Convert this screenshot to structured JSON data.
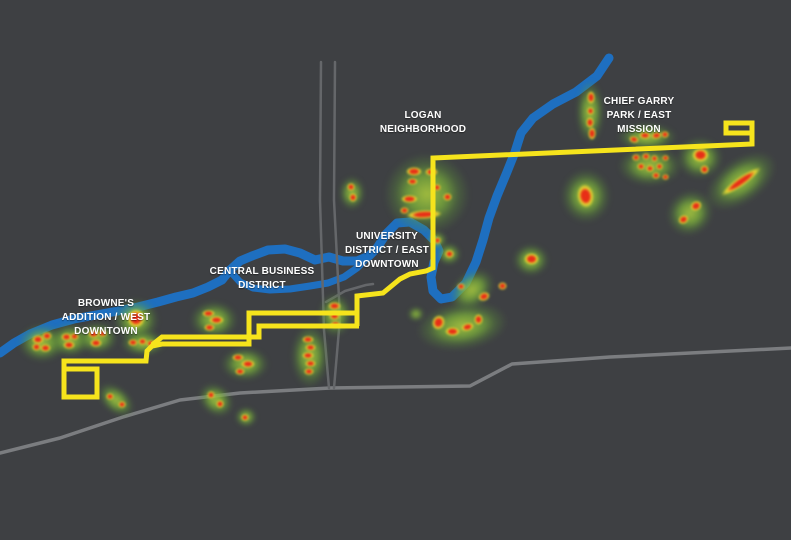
{
  "map": {
    "background_color": "#3e4043",
    "river_color": "#1e6fc0",
    "river_channel_color": "#1e6fc0",
    "route_color": "#f6e41c",
    "road_color": "#7b7d80",
    "minor_road_color": "#65676a",
    "heat_core_color": "#e62c16",
    "heat_glow_color": "#7db53a",
    "labels": [
      {
        "id": "brownes",
        "lines": [
          "BROWNE'S",
          "ADDITION / WEST",
          "DOWNTOWN"
        ],
        "x": 106,
        "y": 297
      },
      {
        "id": "cbd",
        "lines": [
          "CENTRAL BUSINESS",
          "DISTRICT"
        ],
        "x": 262,
        "y": 265
      },
      {
        "id": "university",
        "lines": [
          "UNIVERSITY",
          "DISTRICT / EAST",
          "DOWNTOWN"
        ],
        "x": 387,
        "y": 230
      },
      {
        "id": "logan",
        "lines": [
          "LOGAN",
          "NEIGHBORHOOD"
        ],
        "x": 423,
        "y": 109
      },
      {
        "id": "chief-garry",
        "lines": [
          "CHIEF GARRY",
          "PARK / EAST",
          "MISSION"
        ],
        "x": 639,
        "y": 95
      }
    ],
    "rivers": [
      {
        "name": "spokane-river-main",
        "width": 9,
        "points": [
          [
            609,
            58
          ],
          [
            597,
            76
          ],
          [
            576,
            92
          ],
          [
            553,
            104
          ],
          [
            533,
            118
          ],
          [
            521,
            133
          ],
          [
            515,
            152
          ],
          [
            507,
            172
          ],
          [
            497,
            196
          ],
          [
            489,
            218
          ],
          [
            483,
            240
          ],
          [
            476,
            262
          ],
          [
            466,
            283
          ],
          [
            452,
            297
          ],
          [
            441,
            299
          ],
          [
            433,
            291
          ],
          [
            431,
            277
          ],
          [
            434,
            262
          ],
          [
            439,
            251
          ],
          [
            434,
            240
          ],
          [
            424,
            230
          ],
          [
            410,
            222
          ],
          [
            397,
            223
          ],
          [
            386,
            234
          ],
          [
            377,
            248
          ],
          [
            369,
            256
          ],
          [
            357,
            261
          ],
          [
            343,
            261
          ],
          [
            329,
            257
          ],
          [
            315,
            260
          ],
          [
            300,
            253
          ],
          [
            285,
            249
          ],
          [
            268,
            250
          ],
          [
            252,
            256
          ],
          [
            240,
            261
          ],
          [
            230,
            270
          ],
          [
            222,
            280
          ],
          [
            208,
            287
          ],
          [
            193,
            293
          ],
          [
            176,
            297
          ],
          [
            158,
            302
          ],
          [
            138,
            307
          ],
          [
            118,
            311
          ],
          [
            96,
            315
          ],
          [
            74,
            319
          ],
          [
            52,
            325
          ],
          [
            30,
            334
          ],
          [
            14,
            343
          ],
          [
            0,
            353
          ]
        ]
      },
      {
        "name": "spokane-river-south-channel",
        "width": 7,
        "points": [
          [
            370,
            255
          ],
          [
            357,
            268
          ],
          [
            344,
            277
          ],
          [
            328,
            283
          ],
          [
            310,
            286
          ],
          [
            290,
            289
          ],
          [
            270,
            290
          ],
          [
            253,
            288
          ],
          [
            240,
            282
          ],
          [
            230,
            271
          ]
        ]
      }
    ],
    "roads": [
      {
        "name": "road-southwest-arterial",
        "width": 3.5,
        "minor": false,
        "points": [
          [
            0,
            453
          ],
          [
            60,
            438
          ],
          [
            123,
            417
          ],
          [
            180,
            400
          ],
          [
            240,
            393
          ],
          [
            330,
            388
          ],
          [
            470,
            386
          ],
          [
            512,
            364
          ],
          [
            610,
            357
          ],
          [
            791,
            348
          ]
        ]
      },
      {
        "name": "road-north-south-1",
        "width": 2.5,
        "minor": true,
        "points": [
          [
            321,
            62
          ],
          [
            320,
            200
          ],
          [
            324,
            330
          ],
          [
            329,
            388
          ]
        ]
      },
      {
        "name": "road-north-south-2",
        "width": 2.5,
        "minor": true,
        "points": [
          [
            335,
            62
          ],
          [
            334,
            200
          ],
          [
            340,
            318
          ],
          [
            334,
            388
          ]
        ]
      },
      {
        "name": "road-spur-ne",
        "width": 2.5,
        "minor": true,
        "points": [
          [
            326,
            302
          ],
          [
            345,
            291
          ],
          [
            366,
            285
          ],
          [
            373,
            284
          ]
        ]
      }
    ],
    "route_segments": [
      {
        "name": "route-main",
        "points": [
          [
            750,
            133
          ],
          [
            726,
            133
          ],
          [
            726,
            123
          ],
          [
            752,
            123
          ],
          [
            752,
            144
          ],
          [
            433,
            158
          ],
          [
            433,
            268
          ],
          [
            426,
            271
          ],
          [
            410,
            274
          ],
          [
            400,
            279
          ],
          [
            383,
            293
          ],
          [
            357,
            296
          ],
          [
            357,
            326
          ]
        ]
      },
      {
        "name": "route-westbound-couplet",
        "points": [
          [
            357,
            313
          ],
          [
            249,
            313
          ],
          [
            249,
            344
          ],
          [
            162,
            344
          ],
          [
            152,
            346
          ],
          [
            147,
            351
          ],
          [
            146,
            361
          ],
          [
            64,
            361
          ],
          [
            64,
            397
          ],
          [
            97,
            397
          ],
          [
            97,
            369
          ],
          [
            63,
            369
          ]
        ]
      },
      {
        "name": "route-eastbound-couplet",
        "points": [
          [
            152,
            345
          ],
          [
            162,
            337
          ],
          [
            259,
            337
          ],
          [
            259,
            326
          ],
          [
            359,
            326
          ]
        ]
      }
    ],
    "heat_glows": [
      [
        42,
        343,
        48,
        38,
        0
      ],
      [
        70,
        340,
        42,
        34,
        0
      ],
      [
        97,
        338,
        42,
        32,
        0
      ],
      [
        136,
        320,
        46,
        44,
        0
      ],
      [
        143,
        343,
        46,
        26,
        0
      ],
      [
        116,
        400,
        42,
        26,
        40
      ],
      [
        216,
        400,
        38,
        30,
        40
      ],
      [
        246,
        417,
        22,
        20,
        0
      ],
      [
        214,
        320,
        48,
        38,
        0
      ],
      [
        245,
        364,
        48,
        34,
        0
      ],
      [
        310,
        356,
        38,
        64,
        0
      ],
      [
        335,
        315,
        34,
        44,
        0
      ],
      [
        352,
        193,
        26,
        34,
        0
      ],
      [
        427,
        194,
        86,
        82,
        0
      ],
      [
        437,
        240,
        20,
        18,
        0
      ],
      [
        449,
        254,
        24,
        22,
        0
      ],
      [
        472,
        290,
        50,
        36,
        -40
      ],
      [
        531,
        260,
        36,
        32,
        0
      ],
      [
        462,
        326,
        92,
        48,
        -8
      ],
      [
        416,
        314,
        16,
        14,
        0
      ],
      [
        590,
        112,
        28,
        64,
        0
      ],
      [
        647,
        137,
        60,
        28,
        0
      ],
      [
        650,
        166,
        64,
        40,
        0
      ],
      [
        700,
        158,
        46,
        42,
        0
      ],
      [
        741,
        181,
        80,
        44,
        -35
      ],
      [
        586,
        196,
        50,
        54,
        0
      ],
      [
        690,
        213,
        48,
        44,
        -40
      ]
    ],
    "heat_cores": [
      [
        38,
        339,
        12,
        9,
        0
      ],
      [
        47,
        336,
        10,
        8,
        0
      ],
      [
        36,
        347,
        9,
        8,
        0
      ],
      [
        45,
        348,
        11,
        8,
        0
      ],
      [
        66,
        337,
        11,
        8,
        0
      ],
      [
        74,
        336,
        9,
        7,
        0
      ],
      [
        69,
        345,
        12,
        8,
        0
      ],
      [
        93,
        334,
        11,
        8,
        0
      ],
      [
        102,
        333,
        9,
        7,
        0
      ],
      [
        96,
        343,
        12,
        8,
        0
      ],
      [
        136,
        318,
        18,
        19,
        0
      ],
      [
        133,
        342,
        10,
        7,
        0
      ],
      [
        142,
        341,
        9,
        7,
        0
      ],
      [
        151,
        343,
        10,
        7,
        0
      ],
      [
        110,
        396,
        8,
        7,
        0
      ],
      [
        122,
        404,
        8,
        7,
        0
      ],
      [
        211,
        395,
        8,
        8,
        0
      ],
      [
        220,
        404,
        8,
        8,
        0
      ],
      [
        245,
        417,
        8,
        7,
        0
      ],
      [
        208,
        313,
        13,
        7,
        0
      ],
      [
        216,
        320,
        15,
        8,
        0
      ],
      [
        209,
        327,
        11,
        7,
        0
      ],
      [
        238,
        357,
        12,
        7,
        0
      ],
      [
        248,
        364,
        14,
        8,
        0
      ],
      [
        240,
        371,
        10,
        7,
        0
      ],
      [
        308,
        339,
        12,
        7,
        0
      ],
      [
        310,
        347,
        11,
        7,
        0
      ],
      [
        308,
        355,
        12,
        7,
        0
      ],
      [
        310,
        363,
        11,
        7,
        0
      ],
      [
        309,
        371,
        10,
        7,
        0
      ],
      [
        334,
        306,
        13,
        8,
        0
      ],
      [
        334,
        316,
        11,
        8,
        0
      ],
      [
        335,
        324,
        11,
        7,
        0
      ],
      [
        351,
        187,
        8,
        8,
        0
      ],
      [
        353,
        197,
        8,
        9,
        0
      ],
      [
        414,
        171,
        16,
        9,
        0
      ],
      [
        431,
        172,
        13,
        8,
        0
      ],
      [
        412,
        181,
        11,
        7,
        0
      ],
      [
        437,
        187,
        8,
        7,
        0
      ],
      [
        409,
        199,
        17,
        8,
        0
      ],
      [
        424,
        214,
        36,
        9,
        -3
      ],
      [
        447,
        197,
        9,
        8,
        0
      ],
      [
        404,
        210,
        9,
        7,
        0
      ],
      [
        437,
        240,
        7,
        7,
        0
      ],
      [
        449,
        254,
        9,
        8,
        0
      ],
      [
        461,
        286,
        8,
        7,
        0
      ],
      [
        484,
        296,
        12,
        9,
        -20
      ],
      [
        502,
        286,
        9,
        8,
        0
      ],
      [
        531,
        259,
        15,
        12,
        0
      ],
      [
        438,
        322,
        13,
        15,
        20
      ],
      [
        452,
        331,
        15,
        9,
        0
      ],
      [
        467,
        327,
        13,
        8,
        -15
      ],
      [
        478,
        319,
        9,
        11,
        0
      ],
      [
        591,
        97,
        8,
        13,
        0
      ],
      [
        590,
        111,
        7,
        8,
        0
      ],
      [
        590,
        122,
        8,
        11,
        0
      ],
      [
        592,
        133,
        8,
        13,
        0
      ],
      [
        634,
        139,
        10,
        7,
        15
      ],
      [
        645,
        135,
        12,
        7,
        0
      ],
      [
        656,
        135,
        11,
        7,
        -10
      ],
      [
        665,
        134,
        8,
        7,
        0
      ],
      [
        636,
        157,
        8,
        7,
        0
      ],
      [
        646,
        156,
        8,
        7,
        0
      ],
      [
        654,
        158,
        7,
        7,
        0
      ],
      [
        641,
        166,
        8,
        7,
        0
      ],
      [
        650,
        168,
        8,
        7,
        0
      ],
      [
        659,
        166,
        7,
        7,
        0
      ],
      [
        665,
        158,
        7,
        6,
        0
      ],
      [
        656,
        175,
        8,
        7,
        0
      ],
      [
        665,
        177,
        7,
        6,
        0
      ],
      [
        700,
        155,
        17,
        14,
        0
      ],
      [
        704,
        169,
        9,
        9,
        0
      ],
      [
        741,
        181,
        48,
        9,
        -35
      ],
      [
        585,
        196,
        17,
        24,
        -8
      ],
      [
        683,
        219,
        11,
        9,
        -30
      ],
      [
        696,
        206,
        12,
        10,
        -30
      ]
    ]
  }
}
